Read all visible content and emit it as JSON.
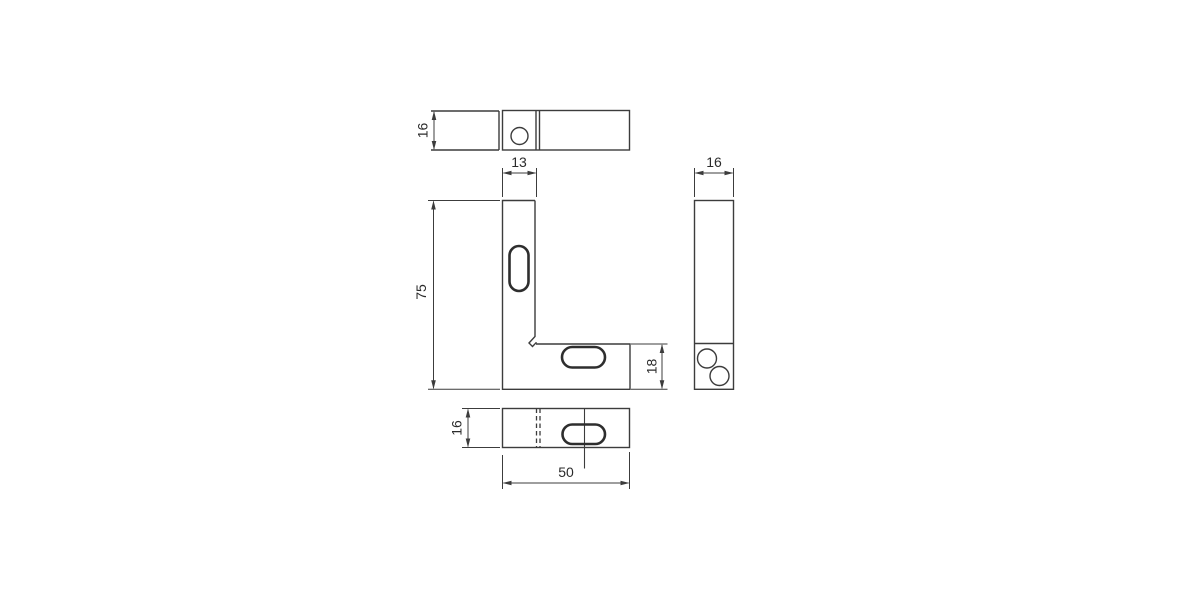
{
  "drawing": {
    "colors": {
      "background": "#ffffff",
      "line": "#3c3c3c",
      "text": "#2b2b2b"
    },
    "dims": {
      "top_depth": "16",
      "leg_width": "13",
      "overall_height": "75",
      "base_height": "18",
      "side_width": "16",
      "bottom_depth": "16",
      "overall_length": "50"
    }
  }
}
